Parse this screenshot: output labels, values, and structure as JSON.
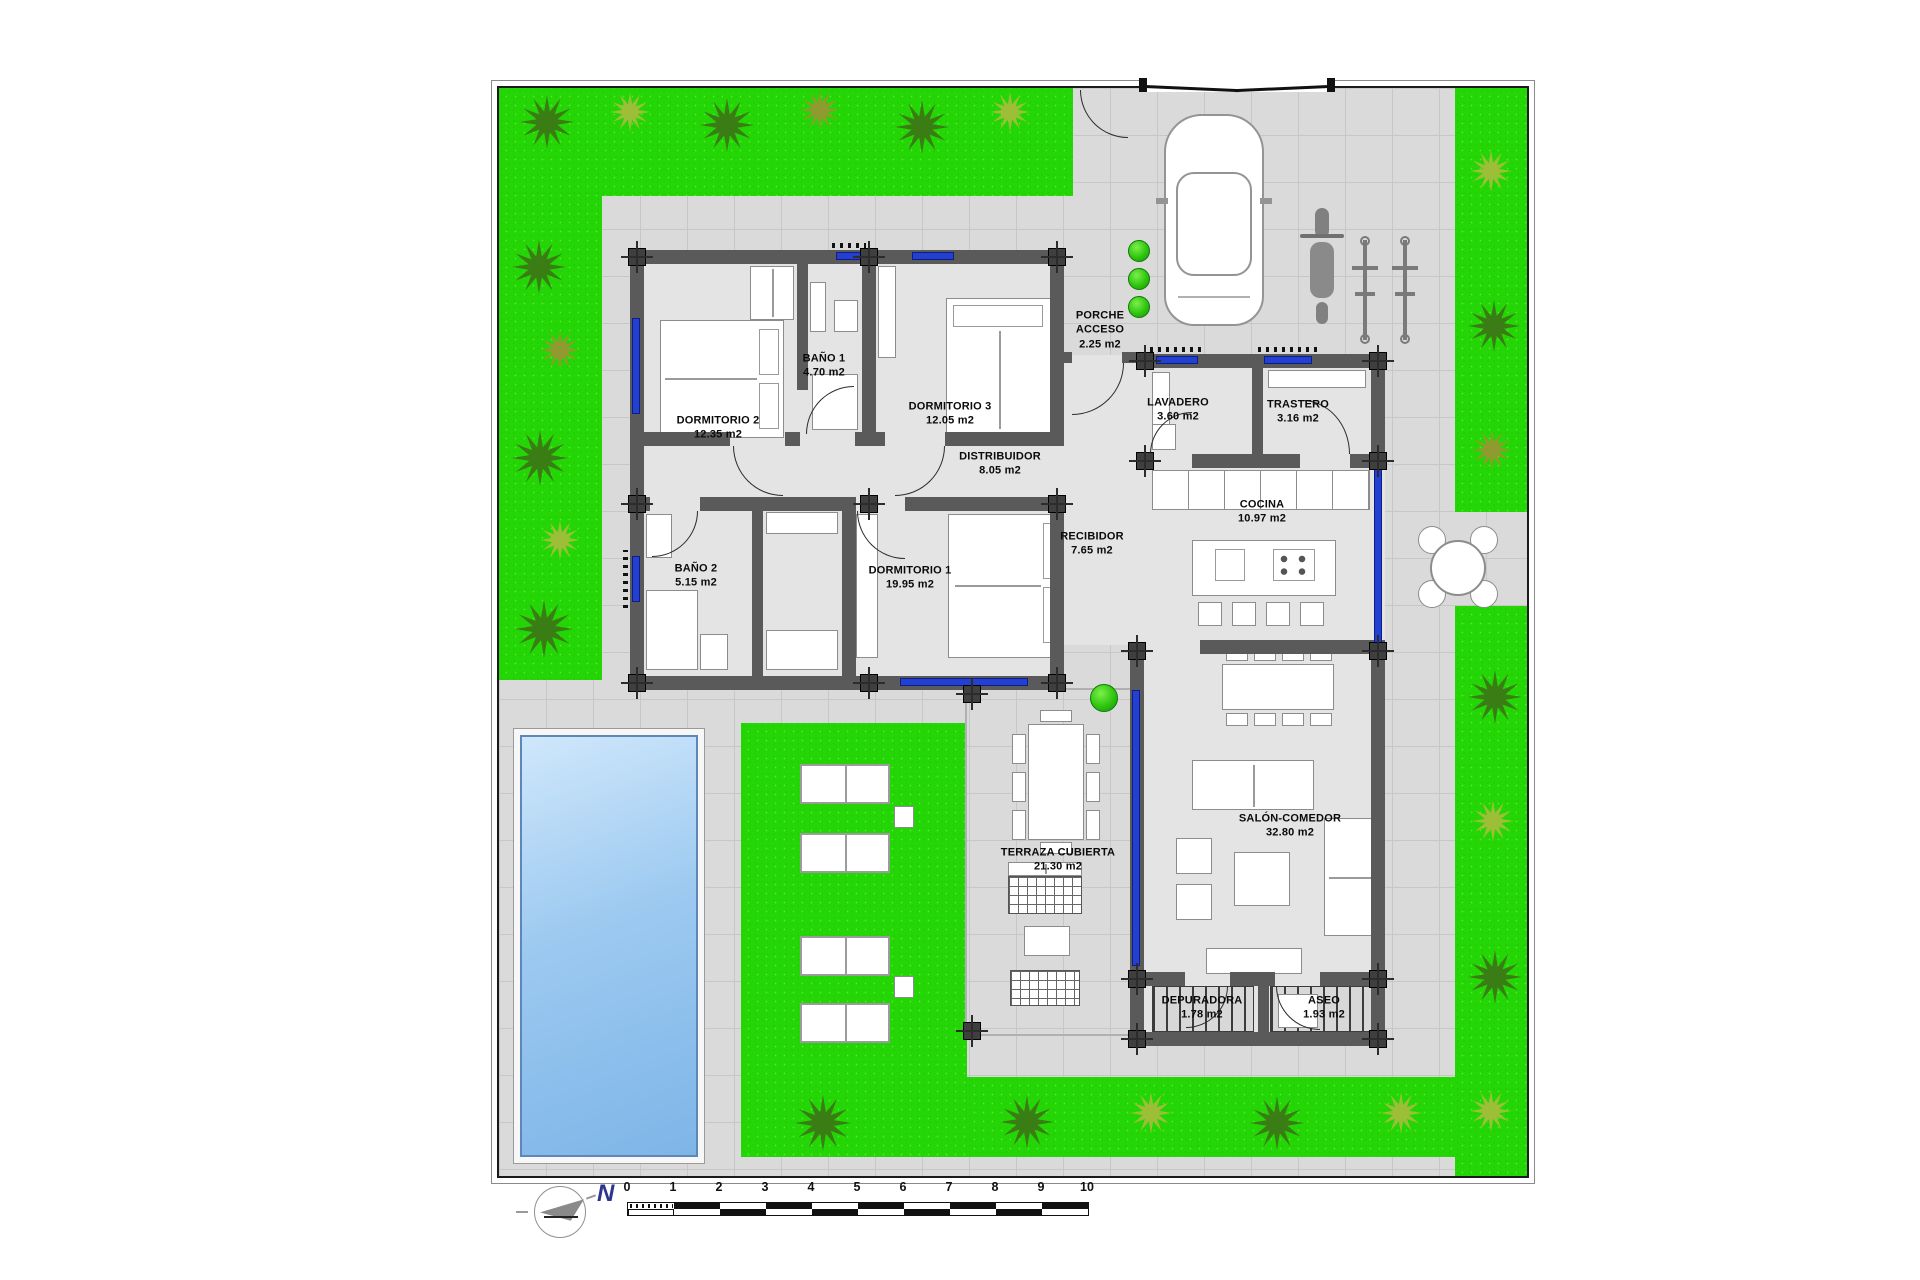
{
  "plan": {
    "rooms": [
      {
        "name": "DORMITORIO 2",
        "area": "12.35 m2"
      },
      {
        "name": "BAÑO 1",
        "area": "4.70 m2"
      },
      {
        "name": "DORMITORIO 3",
        "area": "12.05 m2"
      },
      {
        "name": "PORCHE ACCESO",
        "area": "2.25 m2"
      },
      {
        "name": "LAVADERO",
        "area": "3.60 m2"
      },
      {
        "name": "TRASTERO",
        "area": "3.16 m2"
      },
      {
        "name": "DISTRIBUIDOR",
        "area": "8.05 m2"
      },
      {
        "name": "RECIBIDOR",
        "area": "7.65 m2"
      },
      {
        "name": "COCINA",
        "area": "10.97 m2"
      },
      {
        "name": "BAÑO 2",
        "area": "5.15 m2"
      },
      {
        "name": "DORMITORIO 1",
        "area": "19.95 m2"
      },
      {
        "name": "SALÓN-COMEDOR",
        "area": "32.80 m2"
      },
      {
        "name": "TERRAZA CUBIERTA",
        "area": "21.30 m2"
      },
      {
        "name": "DEPURADORA",
        "area": "1.78 m2"
      },
      {
        "name": "ASEO",
        "area": "1.93 m2"
      }
    ],
    "scale": {
      "ticks": [
        "0",
        "1",
        "2",
        "3",
        "4",
        "5",
        "6",
        "7",
        "8",
        "9",
        "10"
      ]
    },
    "north": {
      "label": "N"
    },
    "colors": {
      "lawn": "#25d606",
      "pool_water": "#9cc9f0",
      "walls": "#5a5a5a",
      "window_glass": "#2340d0",
      "pavement": "#dadada"
    },
    "icons": {
      "car-icon": "top-view rounded rect",
      "motorcycle-icon": "top-view shape",
      "bicycle-icon": "top-view line+hubs",
      "palm-icon": "star-burst",
      "north-arrow-icon": "compass circle"
    }
  }
}
